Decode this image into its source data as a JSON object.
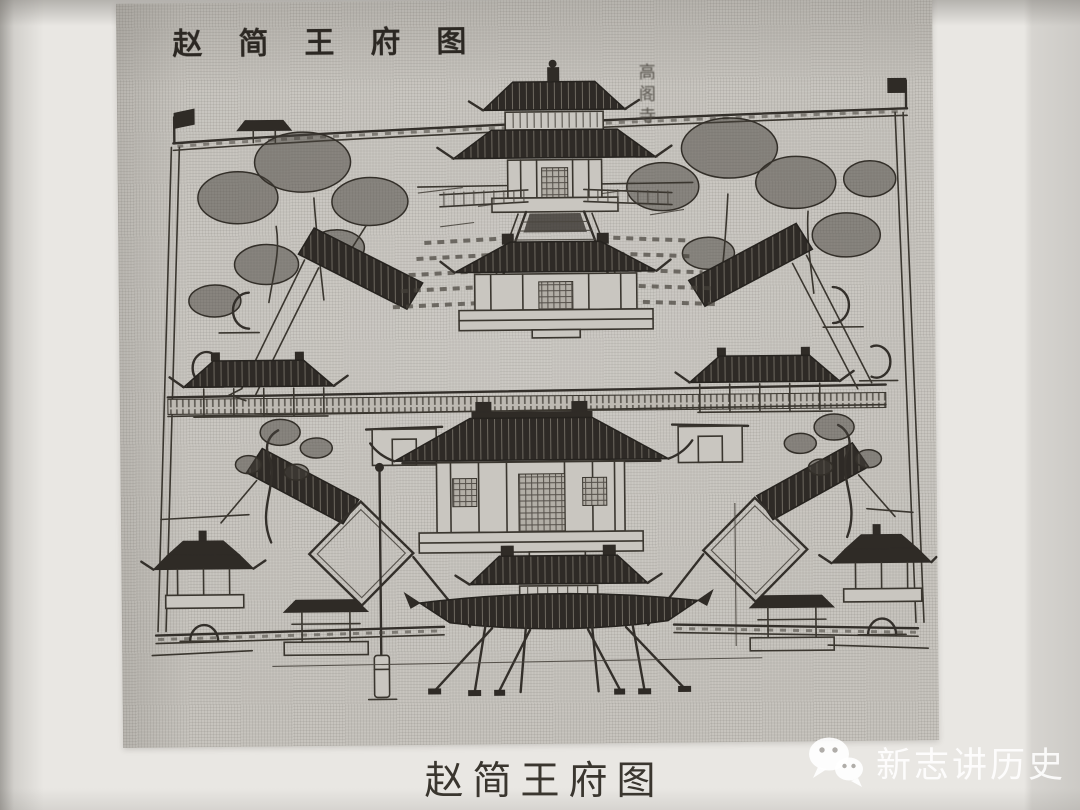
{
  "print": {
    "title": "赵简王府图",
    "building_label": "高阁寺"
  },
  "caption": "赵简王府图",
  "watermark": {
    "icon": "wechat-icon",
    "text": "新志讲历史"
  },
  "colors": {
    "page_paper": "#e9e7e3",
    "print_paper": "#c7c4be",
    "ink": "#332f2a",
    "roof_dark": "#2f2b26",
    "caption_text": "#3a362f",
    "watermark_text": "rgba(255,255,255,0.88)"
  }
}
